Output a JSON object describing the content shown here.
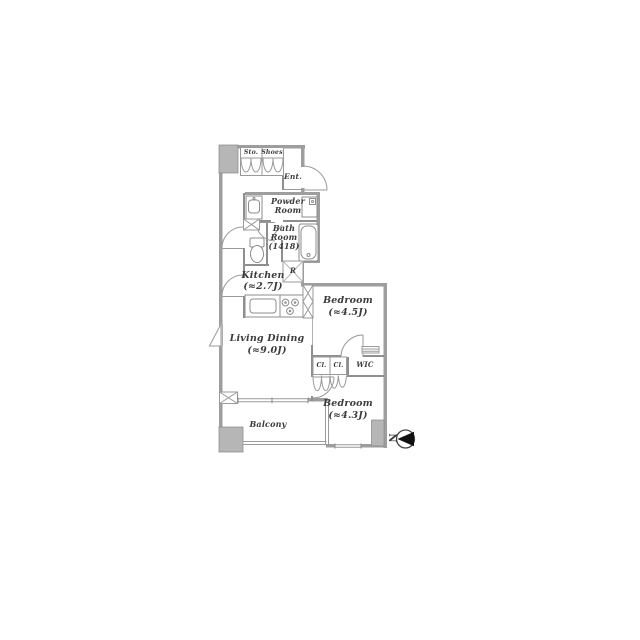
{
  "floorplan": {
    "storage": {
      "label": "Sto."
    },
    "shoes": {
      "label": "Shoes"
    },
    "entrance": {
      "label": "Ent."
    },
    "powder_room": {
      "line1": "Powder",
      "line2": "Room"
    },
    "bath_room": {
      "line1": "Bath",
      "line2": "Room",
      "line3": "(1418)"
    },
    "kitchen": {
      "name": "Kitchen",
      "size": "(≈2.7J)"
    },
    "refrigerator": {
      "label": "R"
    },
    "bedroom_main": {
      "name": "Bedroom",
      "size": "(≈4.5J)"
    },
    "living_dining": {
      "name": "Living Dining",
      "size": "(≈9.0J)"
    },
    "closet1": {
      "label": "Cl."
    },
    "closet2": {
      "label": "Cl."
    },
    "wic": {
      "label": "WIC"
    },
    "bedroom_second": {
      "name": "Bedroom",
      "size": "(≈4.3J)"
    },
    "balcony": {
      "name": "Balcony"
    },
    "compass": {
      "label": "N"
    }
  },
  "colors": {
    "wall": "#9e9e9e",
    "interior_wall": "#8f8f8f",
    "pillar": "#b6b6b6",
    "line": "#9a9a9a",
    "text": "#3b3b3b",
    "background": "#ffffff"
  }
}
